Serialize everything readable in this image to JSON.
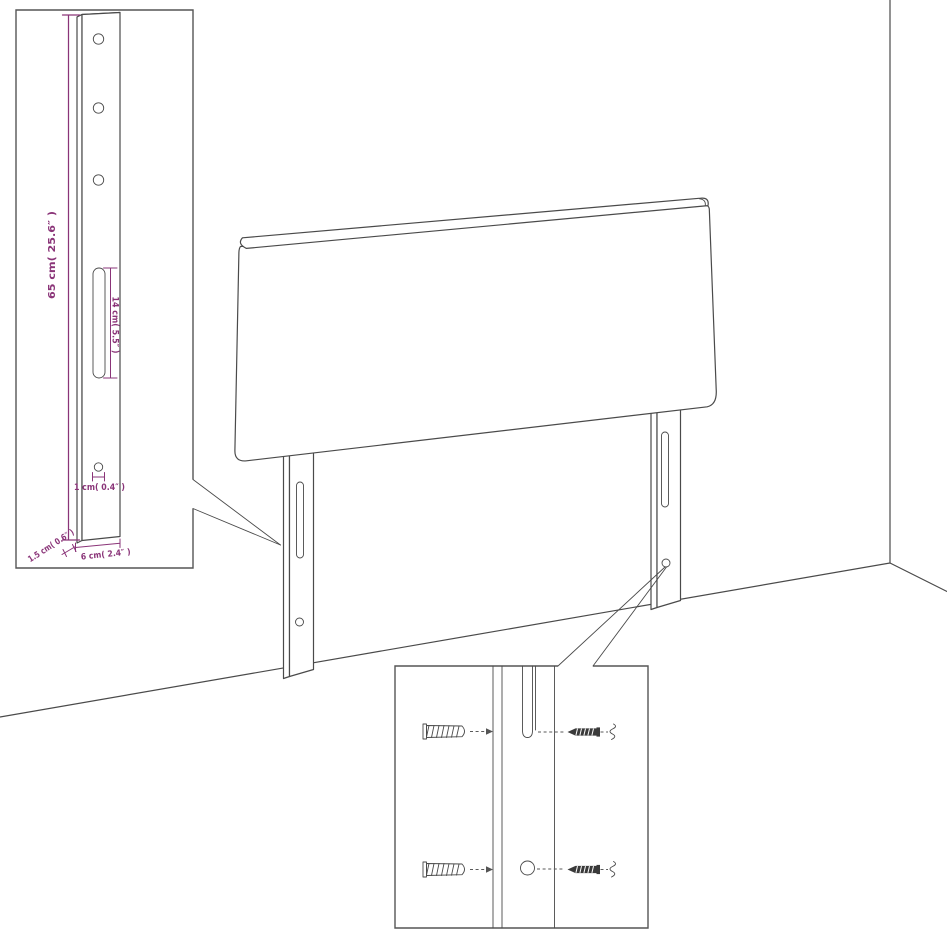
{
  "colors": {
    "background": "#ffffff",
    "line_ink": "#4a4a4a",
    "inset_border": "#555555",
    "dimension_accent": "#8a3478"
  },
  "diagram": {
    "type": "furniture-assembly-dimension-diagram",
    "subject": "headboard-with-two-legs-in-room-corner",
    "leg_detail_inset": {
      "height_label": "65 cm( 25.6″ )",
      "slot_label": "14 cm( 5.5″ )",
      "hole_label": "1 cm( 0.4″ )",
      "thickness_label": "1.5 cm( 0.6″ )",
      "width_label": "6 cm( 2.4″ )"
    },
    "icons": {
      "wall_plug": "wall-plug-icon",
      "screw": "screw-icon",
      "insertion_arrow": "arrow-right-icon",
      "screw_head_end": "screw-cross-icon"
    }
  }
}
